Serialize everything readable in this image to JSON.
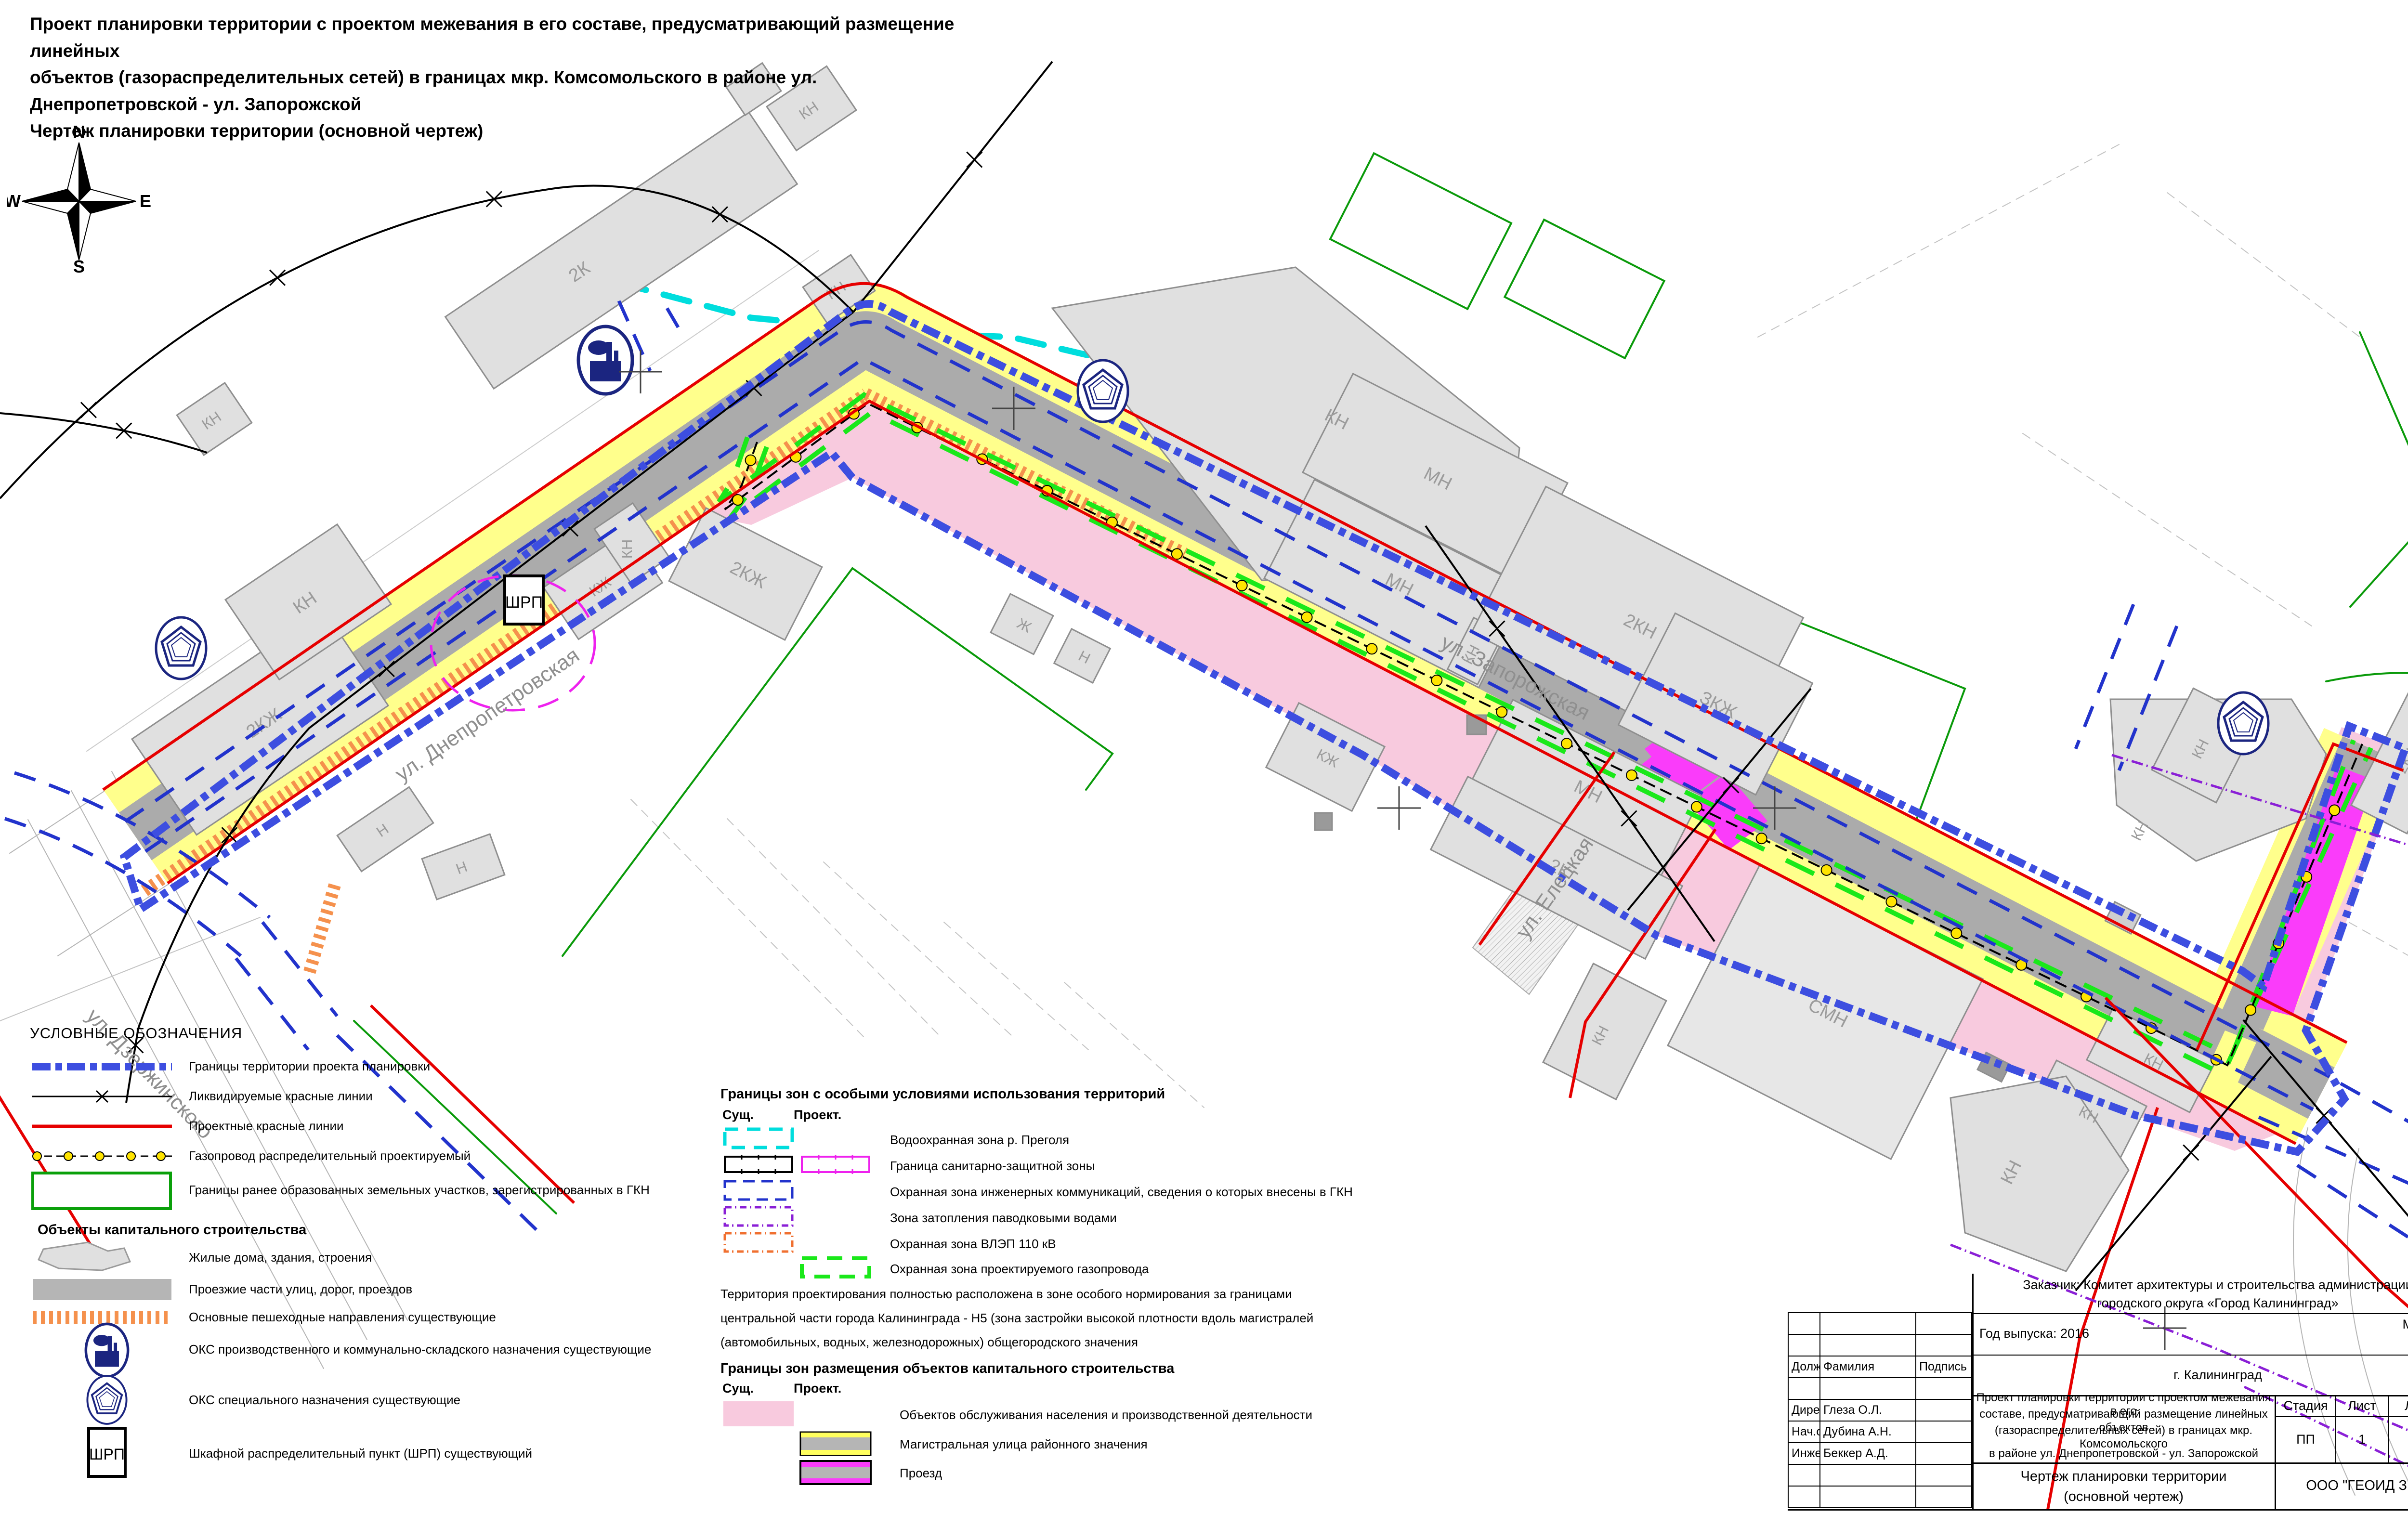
{
  "title": {
    "line1": "Проект планировки территории с проектом межевания в его составе, предусматривающий размещение линейных",
    "line2": "объектов (газораспределительных сетей) в границах мкр. Комсомольского в районе ул. Днепропетровской - ул. Запорожской",
    "line3": "Чертеж планировки территории (основной чертеж)"
  },
  "compass": {
    "north": "N",
    "south": "S",
    "east": "E",
    "west": "W"
  },
  "legend": {
    "heading": "УСЛОВНЫЕ ОБОЗНАЧЕНИЯ",
    "items": [
      "Границы территории проекта планировки",
      "Ликвидируемые красные линии",
      "Проектные красные линии",
      "Газопровод распределительный проектируемый",
      "Границы ранее образованных земельных участков, зарегистрированных в ГКН"
    ],
    "capital_heading": "Объекты капитального строительства",
    "capital_items": [
      "Жилые дома, здания, строения",
      "Проезжие части улиц, дорог, проездов",
      "Основные пешеходные направления существующие"
    ],
    "oks_items": [
      "ОКС производственного и коммунально-складского назначения существующие",
      "ОКС специального назначения существующие",
      "Шкафной распределительный пункт (ШРП) существующий"
    ]
  },
  "zones_legend": {
    "heading": "Границы зон с особыми условиями использования территорий",
    "col_existing": "Сущ.",
    "col_project": "Проект.",
    "items": [
      "Водоохранная зона р. Преголя",
      "Граница санитарно-защитной зоны",
      "Охранная зона инженерных коммуникаций, сведения о которых внесены в ГКН",
      "Зона затопления паводковыми водами",
      "Охранная зона ВЛЭП 110 кВ",
      "Охранная зона проектируемого газопровода"
    ],
    "note_line1": "Территория проектирования полностью расположена в зоне особого нормирования за границами",
    "note_line2": "центральной части города Калининграда - Н5 (зона застройки высокой плотности вдоль магистралей",
    "note_line3": "(автомобильных, водных, железнодорожных) общегородского значения"
  },
  "capital_zones_legend": {
    "heading": "Границы зон размещения объектов капитального строительства",
    "col_existing": "Сущ.",
    "col_project": "Проект.",
    "items": [
      "Объектов обслуживания населения и производственной деятельности",
      "Магистральная улица районного значения",
      "Проезд"
    ]
  },
  "title_block": {
    "customer_line1": "Заказчик: Комитет архитектуры и строительства администрации",
    "customer_line2": "городского округа «Город Калининград»",
    "year": "Год выпуска: 2016",
    "scale_label": "Масштаб",
    "scale_value": "1:1000",
    "city": "г. Калининград",
    "col_position": "Должн-ть",
    "col_name": "Фамилия",
    "col_sign": "Подпись",
    "rows": [
      {
        "position": "Директор",
        "name": "Глеза О.Л."
      },
      {
        "position": "Нач.отд.",
        "name": "Дубина А.Н."
      },
      {
        "position": "Инженер",
        "name": "Беккер А.Д."
      }
    ],
    "project_line1": "Проект планировки территории с проектом межевания в его",
    "project_line2": "составе, предусматривающий размещение линейных объектов",
    "project_line3": "(газораспределительных сетей) в границах мкр. Комсомольского",
    "project_line4": "в районе ул. Днепропетровской - ул. Запорожской",
    "stage_label": "Стадия",
    "sheet_label": "Лист",
    "sheets_label": "Листов",
    "stage": "ПП",
    "sheet": "1",
    "sheets": "7",
    "drawing_name_line1": "Чертеж планировки территории",
    "drawing_name_line2": "(основной чертеж)",
    "company": "ООО \"ГЕОИД ЗЕМ\""
  },
  "map": {
    "streets": [
      "ул. Днепропетровская",
      "ул. Запорожская",
      "ул. Елецкая",
      "ул. Дзержинского"
    ],
    "buildings": [
      "2К",
      "КН",
      "КН",
      "2КЖ",
      "КН",
      "Н",
      "Н",
      "КЖ",
      "КН",
      "2КЖ",
      "Ж",
      "Н",
      "КН",
      "КН",
      "МН",
      "МН",
      "КН",
      "2КН",
      "ЗКЖ",
      "МН",
      "КЖ",
      "2К",
      "СМН",
      "КН",
      "КН",
      "КН",
      "2КЖ",
      "КЖ",
      "КН",
      "КН",
      "КН"
    ],
    "shrp_label": "ШРП",
    "colors": {
      "project_boundary": "#3d4ee0",
      "red_line": "#e60000",
      "gas_zone_green": "#1ae81a",
      "road_gray": "#ababab",
      "roadside_yellow": "#ffff8c",
      "service_pink": "#f8cade",
      "driveway_magenta": "#fa3cfa",
      "water_zone_cyan": "#00dddd",
      "flood_purple": "#8a1fd6",
      "vlep_orange": "#f07030",
      "pedestrian_orange": "#f5914d",
      "parcel_green": "#0a9a0a",
      "icon_navy": "#1b2580"
    }
  }
}
